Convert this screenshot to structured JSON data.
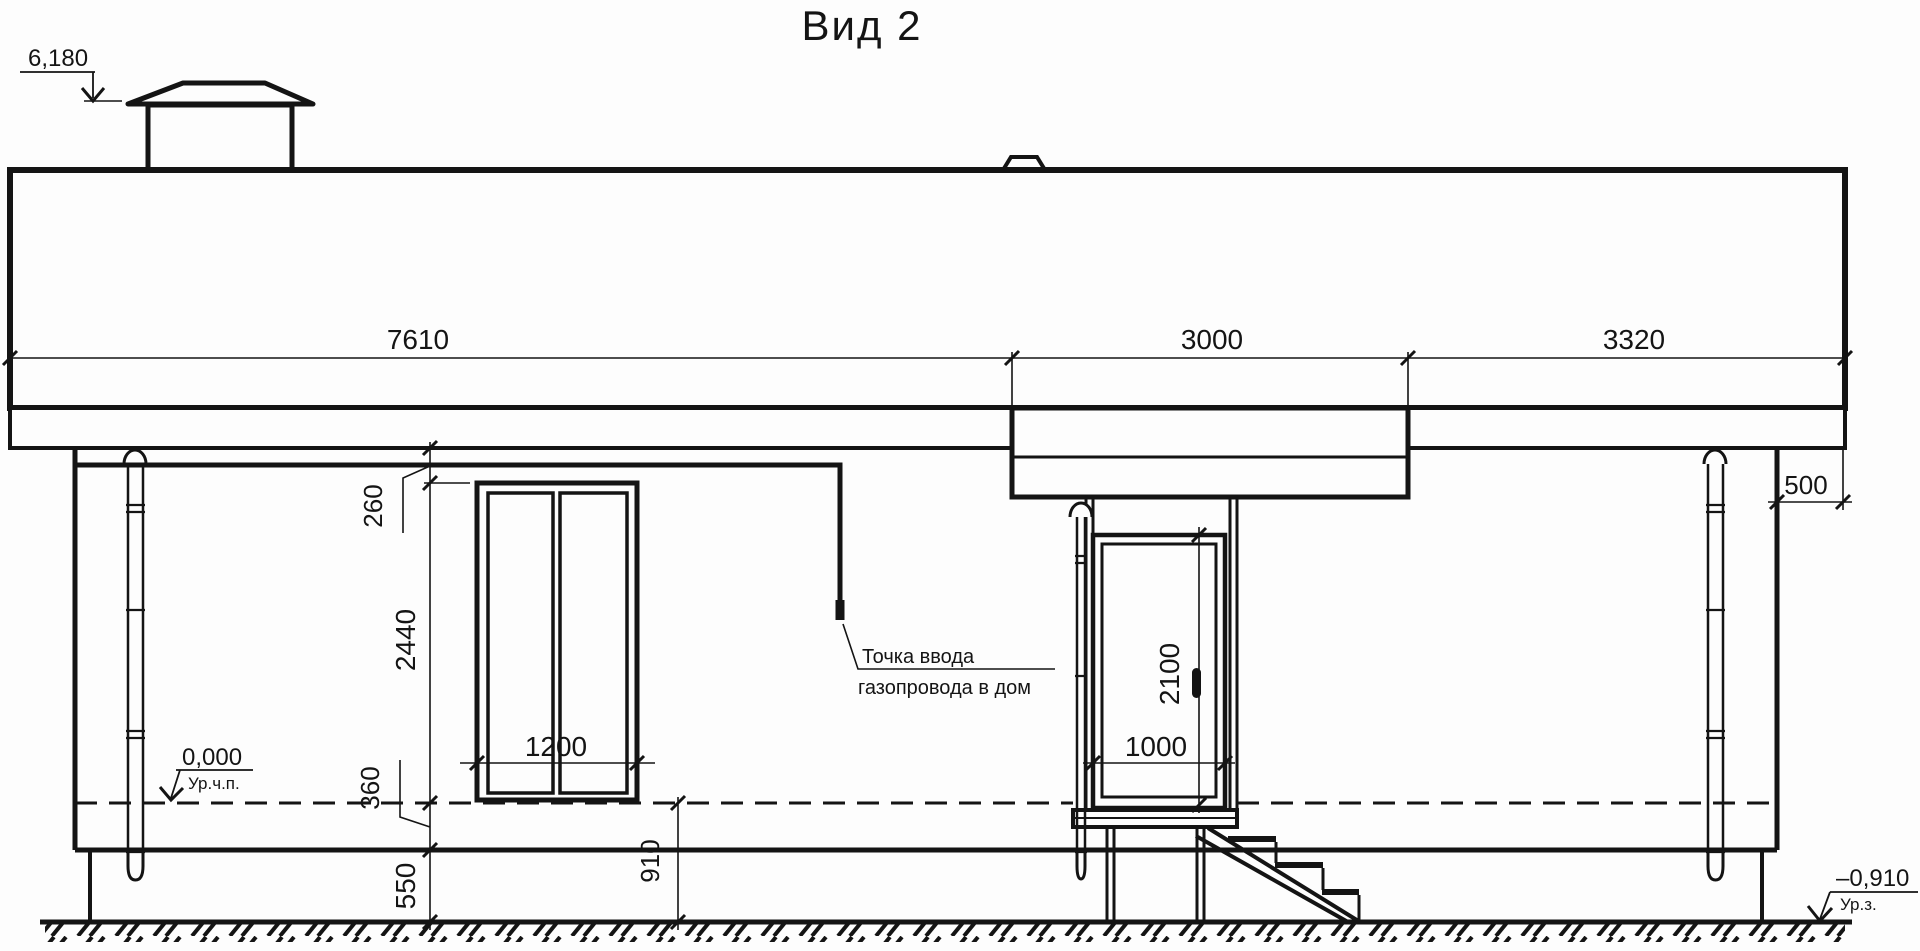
{
  "drawing": {
    "title": "Вид 2",
    "elevation_marks": {
      "chimney": {
        "value": "6,180"
      },
      "floor": {
        "value": "0,000",
        "caption": "Ур.ч.п."
      },
      "ground": {
        "value": "–0,910",
        "caption": "Ур.з."
      }
    },
    "dimensions": {
      "roof_segments": [
        "7610",
        "3000",
        "3320"
      ],
      "roof_overhang_right": "500",
      "eave_to_window_top": "260",
      "window_height": "2440",
      "window_width": "1200",
      "floor_to_plinth_top": "360",
      "plinth_height": "550",
      "floor_to_ground": "910",
      "door_width": "1000",
      "door_height": "2100"
    },
    "annotation": {
      "gas_entry_line1": "Точка ввода",
      "gas_entry_line2": "газопровода в дом"
    },
    "colors": {
      "ink": "#141414",
      "paper": "#fdfdfd"
    }
  }
}
